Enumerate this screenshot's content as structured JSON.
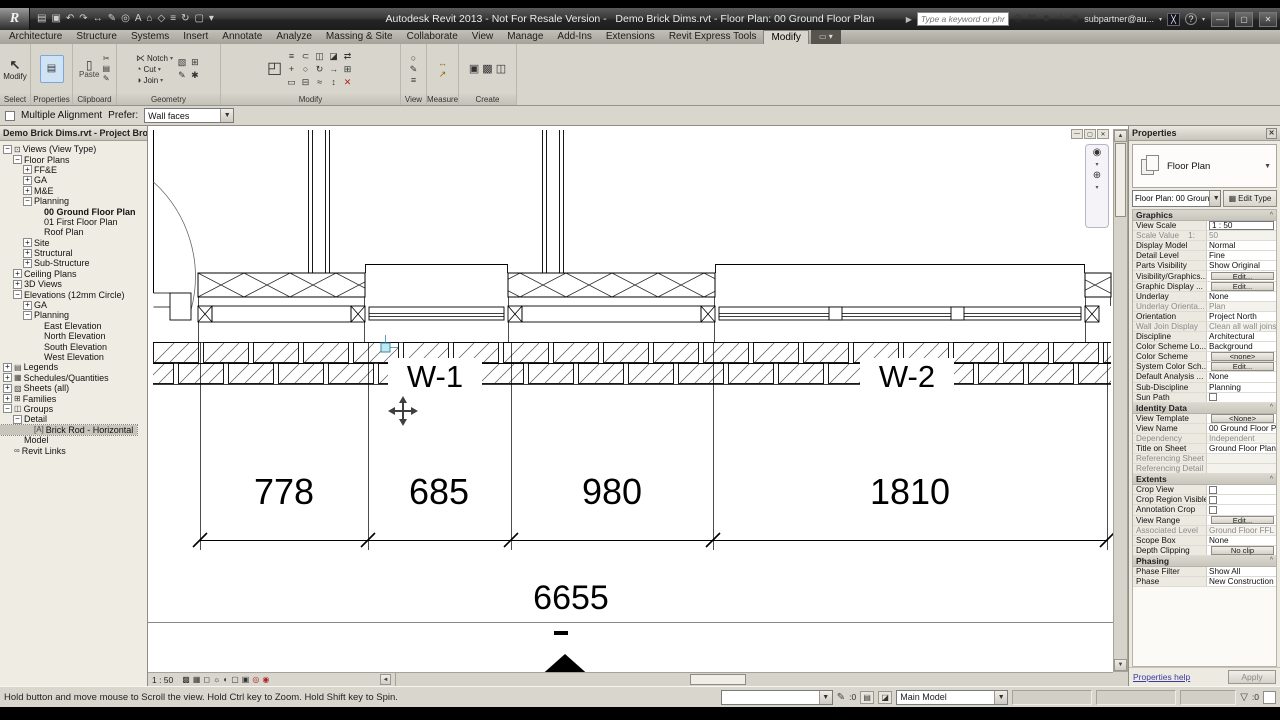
{
  "colors": {
    "selection_blue": "#cfe3f5",
    "ribbon_bg": "#d8d5cc",
    "titlebar": "#2b2b2b",
    "delete_red": "#b22222",
    "grip_cyan": "#bfe8f2"
  },
  "icons": {
    "cursor": "↖",
    "paste": "▯",
    "properties": "▤",
    "tab_overflow": "▭ ▾",
    "nav_wheel": "◉",
    "nav_zoom": "⊕",
    "caret": "▾",
    "edit_type": "▦",
    "pb_close": "✕",
    "props_close": "✕",
    "win_min": "—",
    "win_restore": "▢",
    "win_close": "✕",
    "cv_min": "—",
    "cv_restore": "▢",
    "cv_close": "✕",
    "up": "▲",
    "down": "▼",
    "left": "◄",
    "right": "►",
    "filter": "▽",
    "pencil": "✎"
  },
  "title_bar": {
    "app_icon_letter": "R",
    "qat_icons": [
      {
        "n": "open",
        "g": "▤"
      },
      {
        "n": "save",
        "g": "▣"
      },
      {
        "n": "undo",
        "g": "↶"
      },
      {
        "n": "redo",
        "g": "↷"
      },
      {
        "n": "aligned-dimension",
        "g": "↔"
      },
      {
        "n": "tag",
        "g": "✎"
      },
      {
        "n": "zoom",
        "g": "◎"
      },
      {
        "n": "text",
        "g": "A"
      },
      {
        "n": "default-3d-view",
        "g": "⌂"
      },
      {
        "n": "section",
        "g": "◇"
      },
      {
        "n": "thin-lines",
        "g": "≡"
      },
      {
        "n": "synchronize",
        "g": "↻"
      },
      {
        "n": "close-hidden-windows",
        "g": "▢"
      },
      {
        "n": "customize-qat",
        "g": "▾"
      }
    ],
    "title": "Autodesk Revit 2013 - Not For Resale Version -   Demo Brick Dims.rvt - Floor Plan: 00 Ground Floor Plan",
    "search_placeholder": "Type a keyword or phrase",
    "comm_icons": [
      {
        "n": "search-binoculars",
        "g": "◎"
      },
      {
        "n": "subscription",
        "g": "✉"
      },
      {
        "n": "communication-center",
        "g": "☻"
      },
      {
        "n": "favorites",
        "g": "☆"
      },
      {
        "n": "sign-in",
        "g": "◉"
      }
    ],
    "account": "subpartner@au...",
    "help": "?"
  },
  "ribbon": {
    "tabs": [
      {
        "label": "Architecture"
      },
      {
        "label": "Structure"
      },
      {
        "label": "Systems"
      },
      {
        "label": "Insert"
      },
      {
        "label": "Annotate"
      },
      {
        "label": "Analyze"
      },
      {
        "label": "Massing & Site"
      },
      {
        "label": "Collaborate"
      },
      {
        "label": "View"
      },
      {
        "label": "Manage"
      },
      {
        "label": "Add-Ins"
      },
      {
        "label": "Extensions"
      },
      {
        "label": "Revit Express Tools"
      },
      {
        "label": "Modify",
        "active": true
      }
    ],
    "panel_labels": [
      "Select",
      "Properties",
      "Clipboard",
      "Geometry",
      "Modify",
      "View",
      "Measure",
      "Create"
    ],
    "select_button": "Modify",
    "paste_label": "Paste",
    "clipboard_side_icons": [
      {
        "n": "cut-clipboard",
        "g": "✂"
      },
      {
        "n": "copy-clipboard",
        "g": "▤"
      },
      {
        "n": "match-type",
        "g": "✎"
      }
    ],
    "geometry_items": [
      {
        "n": "notch",
        "g": "⋉",
        "label": "Notch"
      },
      {
        "n": "cut-geometry",
        "g": "◔",
        "label": "Cut"
      },
      {
        "n": "join-geometry",
        "g": "◑",
        "label": "Join"
      }
    ],
    "geometry_side_icons": [
      {
        "n": "wall-layers",
        "g": "▧"
      },
      {
        "n": "beam-join",
        "g": "⊞"
      },
      {
        "n": "demolish",
        "g": "✎"
      },
      {
        "n": "paint",
        "g": "✱"
      }
    ],
    "modify_big_icons": [
      {
        "n": "wall-joins",
        "g": "◰"
      }
    ],
    "modify_grid_icons": [
      {
        "n": "align",
        "g": "≡"
      },
      {
        "n": "offset",
        "g": "⊂"
      },
      {
        "n": "mirror-pick-axis",
        "g": "◫"
      },
      {
        "n": "mirror-draw-axis",
        "g": "◪"
      },
      {
        "n": "split-with-gap",
        "g": "⇄"
      },
      {
        "n": "move",
        "g": "+"
      },
      {
        "n": "copy",
        "g": "○"
      },
      {
        "n": "rotate",
        "g": "↻"
      },
      {
        "n": "trim-extend",
        "g": "→"
      },
      {
        "n": "array",
        "g": "⊞"
      },
      {
        "n": "scale",
        "g": "▭"
      },
      {
        "n": "pin",
        "g": "⊟"
      },
      {
        "n": "unpin",
        "g": "≈"
      },
      {
        "n": "split-element",
        "g": "↕"
      },
      {
        "n": "delete",
        "g": "✕",
        "red": true
      }
    ],
    "view_icons": [
      {
        "n": "render",
        "g": "○"
      },
      {
        "n": "sketchy-lines",
        "g": "✎"
      },
      {
        "n": "thin-lines-toggle",
        "g": "≡"
      }
    ],
    "measure_icons": [
      {
        "n": "measure-between-refs",
        "g": "↔"
      },
      {
        "n": "measure-along-element",
        "g": "↗"
      }
    ],
    "create_icons": [
      {
        "n": "legend-component",
        "g": "▣"
      },
      {
        "n": "detail-group",
        "g": "▩"
      },
      {
        "n": "create-similar",
        "g": "◫"
      }
    ]
  },
  "options_bar": {
    "multiple_alignment": "Multiple Alignment",
    "prefer_label": "Prefer:",
    "prefer_value": "Wall faces"
  },
  "project_browser": {
    "title": "Demo Brick Dims.rvt - Project Bro...",
    "items": [
      {
        "label": "Views (View Type)",
        "indent": 0,
        "exp": "minus",
        "icon": "⊡"
      },
      {
        "label": "Floor Plans",
        "indent": 1,
        "exp": "minus"
      },
      {
        "label": "FF&E",
        "indent": 2,
        "exp": "plus"
      },
      {
        "label": "GA",
        "indent": 2,
        "exp": "plus"
      },
      {
        "label": "M&E",
        "indent": 2,
        "exp": "plus"
      },
      {
        "label": "Planning",
        "indent": 2,
        "exp": "minus"
      },
      {
        "label": "00 Ground Floor Plan",
        "indent": 3,
        "exp": "none",
        "bold": true
      },
      {
        "label": "01 First Floor Plan",
        "indent": 3,
        "exp": "none"
      },
      {
        "label": "Roof Plan",
        "indent": 3,
        "exp": "none"
      },
      {
        "label": "Site",
        "indent": 2,
        "exp": "plus"
      },
      {
        "label": "Structural",
        "indent": 2,
        "exp": "plus"
      },
      {
        "label": "Sub-Structure",
        "indent": 2,
        "exp": "plus"
      },
      {
        "label": "Ceiling Plans",
        "indent": 1,
        "exp": "plus"
      },
      {
        "label": "3D Views",
        "indent": 1,
        "exp": "plus"
      },
      {
        "label": "Elevations (12mm Circle)",
        "indent": 1,
        "exp": "minus"
      },
      {
        "label": "GA",
        "indent": 2,
        "exp": "plus"
      },
      {
        "label": "Planning",
        "indent": 2,
        "exp": "minus"
      },
      {
        "label": "East Elevation",
        "indent": 3,
        "exp": "none"
      },
      {
        "label": "North Elevation",
        "indent": 3,
        "exp": "none"
      },
      {
        "label": "South Elevation",
        "indent": 3,
        "exp": "none"
      },
      {
        "label": "West Elevation",
        "indent": 3,
        "exp": "none"
      },
      {
        "label": "Legends",
        "indent": 0,
        "exp": "plus",
        "icon": "▤"
      },
      {
        "label": "Schedules/Quantities",
        "indent": 0,
        "exp": "plus",
        "icon": "▦"
      },
      {
        "label": "Sheets (all)",
        "indent": 0,
        "exp": "plus",
        "icon": "▧"
      },
      {
        "label": "Families",
        "indent": 0,
        "exp": "plus",
        "icon": "⊞"
      },
      {
        "label": "Groups",
        "indent": 0,
        "exp": "minus",
        "icon": "◫"
      },
      {
        "label": "Detail",
        "indent": 1,
        "exp": "minus"
      },
      {
        "label": "Brick Rod - Horizontal",
        "indent": 2,
        "exp": "none",
        "icon": "[A]",
        "selected": true
      },
      {
        "label": "Model",
        "indent": 1,
        "exp": "none"
      },
      {
        "label": "Revit Links",
        "indent": 0,
        "exp": "none",
        "icon": "∞"
      }
    ]
  },
  "canvas": {
    "w1": "W-1",
    "w2": "W-2",
    "dims": [
      "778",
      "685",
      "980",
      "1810"
    ],
    "total": "6655",
    "view_scale": "1 : 50"
  },
  "view_bar_icons": [
    {
      "n": "scale-bar",
      "g": "▩"
    },
    {
      "n": "detail-level",
      "g": "▦"
    },
    {
      "n": "visual-style",
      "g": "◻"
    },
    {
      "n": "sun-path",
      "g": "☼"
    },
    {
      "n": "shadows",
      "g": "◐"
    },
    {
      "n": "crop-view",
      "g": "▢"
    },
    {
      "n": "show-crop-region",
      "g": "▣"
    },
    {
      "n": "temporary-hide-isolate",
      "g": "◎",
      "red": true
    },
    {
      "n": "reveal-hidden-elements",
      "g": "◉",
      "red": true
    }
  ],
  "properties": {
    "title": "Properties",
    "type_name": "Floor Plan",
    "instance": "Floor Plan: 00 Groun",
    "edit_type": "Edit Type",
    "help": "Properties help",
    "apply": "Apply",
    "rows": [
      {
        "t": "h",
        "label": "Graphics"
      },
      {
        "t": "r",
        "label": "View Scale",
        "value": "1 : 50",
        "kind": "field"
      },
      {
        "t": "r",
        "label": "Scale Value    1:",
        "value": "50",
        "gray": true
      },
      {
        "t": "r",
        "label": "Display Model",
        "value": "Normal"
      },
      {
        "t": "r",
        "label": "Detail Level",
        "value": "Fine"
      },
      {
        "t": "r",
        "label": "Parts Visibility",
        "value": "Show Original"
      },
      {
        "t": "r",
        "label": "Visibility/Graphics...",
        "value": "Edit...",
        "kind": "button"
      },
      {
        "t": "r",
        "label": "Graphic Display ...",
        "value": "Edit...",
        "kind": "button"
      },
      {
        "t": "r",
        "label": "Underlay",
        "value": "None"
      },
      {
        "t": "r",
        "label": "Underlay Orienta...",
        "value": "Plan",
        "gray": true
      },
      {
        "t": "r",
        "label": "Orientation",
        "value": "Project North"
      },
      {
        "t": "r",
        "label": "Wall Join Display",
        "value": "Clean all wall joins",
        "gray": true
      },
      {
        "t": "r",
        "label": "Discipline",
        "value": "Architectural"
      },
      {
        "t": "r",
        "label": "Color Scheme Lo...",
        "value": "Background"
      },
      {
        "t": "r",
        "label": "Color Scheme",
        "value": "<none>",
        "kind": "button"
      },
      {
        "t": "r",
        "label": "System Color Sch...",
        "value": "Edit...",
        "kind": "button"
      },
      {
        "t": "r",
        "label": "Default Analysis ...",
        "value": "None"
      },
      {
        "t": "r",
        "label": "Sub-Discipline",
        "value": "Planning"
      },
      {
        "t": "r",
        "label": "Sun Path",
        "value": "",
        "kind": "checkbox"
      },
      {
        "t": "h",
        "label": "Identity Data"
      },
      {
        "t": "r",
        "label": "View Template",
        "value": "<None>",
        "kind": "button"
      },
      {
        "t": "r",
        "label": "View Name",
        "value": "00 Ground Floor Plan"
      },
      {
        "t": "r",
        "label": "Dependency",
        "value": "Independent",
        "gray": true
      },
      {
        "t": "r",
        "label": "Title on Sheet",
        "value": "Ground Floor Plan"
      },
      {
        "t": "r",
        "label": "Referencing Sheet",
        "value": "",
        "gray": true
      },
      {
        "t": "r",
        "label": "Referencing Detail",
        "value": "",
        "gray": true
      },
      {
        "t": "h",
        "label": "Extents"
      },
      {
        "t": "r",
        "label": "Crop View",
        "value": "",
        "kind": "checkbox"
      },
      {
        "t": "r",
        "label": "Crop Region Visible",
        "value": "",
        "kind": "checkbox"
      },
      {
        "t": "r",
        "label": "Annotation Crop",
        "value": "",
        "kind": "checkbox"
      },
      {
        "t": "r",
        "label": "View Range",
        "value": "Edit...",
        "kind": "button"
      },
      {
        "t": "r",
        "label": "Associated Level",
        "value": "Ground Floor FFL",
        "gray": true
      },
      {
        "t": "r",
        "label": "Scope Box",
        "value": "None"
      },
      {
        "t": "r",
        "label": "Depth Clipping",
        "value": "No clip",
        "kind": "button"
      },
      {
        "t": "h",
        "label": "Phasing"
      },
      {
        "t": "r",
        "label": "Phase Filter",
        "value": "Show All"
      },
      {
        "t": "r",
        "label": "Phase",
        "value": "New Construction"
      }
    ]
  },
  "status_bar": {
    "message": "Hold button and move mouse to Scroll the view. Hold Ctrl key to Zoom. Hold Shift key to Spin.",
    "pencil_count": ":0",
    "main_model": "Main Model",
    "filter_count": ":0"
  }
}
